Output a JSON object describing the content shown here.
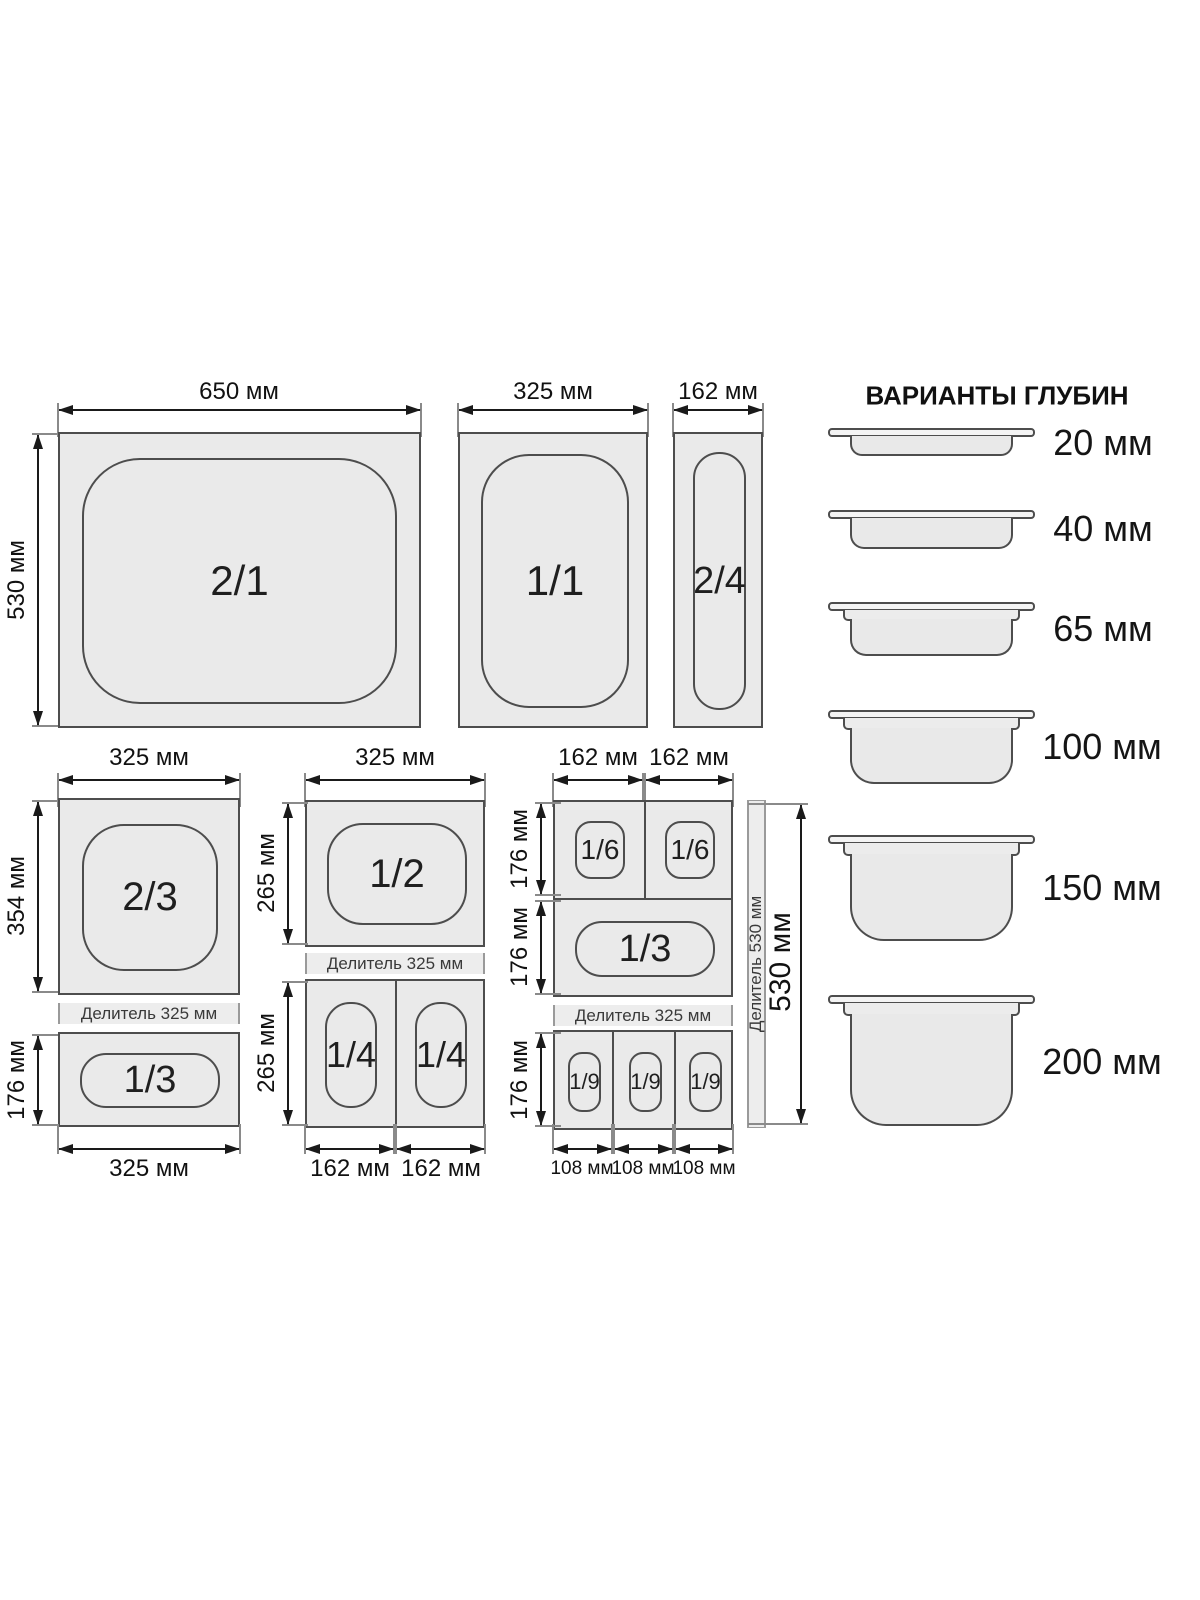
{
  "diagram": {
    "top_row": {
      "pan_2_1": {
        "label": "2/1",
        "width_dim": "650 мм",
        "height_dim": "530 мм"
      },
      "pan_1_1": {
        "label": "1/1",
        "width_dim": "325 мм"
      },
      "pan_2_4": {
        "label": "2/4",
        "width_dim": "162 мм"
      }
    },
    "left_column": {
      "top_dim": "325 мм",
      "pan_2_3": {
        "label": "2/3",
        "height_dim": "354 мм"
      },
      "divider_label": "Делитель 325 мм",
      "pan_1_3": {
        "label": "1/3",
        "height_dim": "176 мм"
      },
      "bottom_dim": "325 мм"
    },
    "middle_column": {
      "top_dim": "325 мм",
      "pan_1_2": {
        "label": "1/2",
        "height_dim": "265 мм"
      },
      "divider_label": "Делитель 325 мм",
      "pan_1_4_row": {
        "labels": [
          "1/4",
          "1/4"
        ],
        "height_dim": "265 мм",
        "bottom_dims": [
          "162 мм",
          "162 мм"
        ]
      }
    },
    "right_column": {
      "top_dims": [
        "162 мм",
        "162 мм"
      ],
      "pan_1_6_row": {
        "labels": [
          "1/6",
          "1/6"
        ],
        "height_dim": "176 мм"
      },
      "pan_1_3": {
        "label": "1/3",
        "height_dim": "176 мм"
      },
      "divider_label": "Делитель 325 мм",
      "pan_1_9_row": {
        "labels": [
          "1/9",
          "1/9",
          "1/9"
        ],
        "height_dim": "176 мм",
        "bottom_dims": [
          "108 мм",
          "108 мм",
          "108 мм"
        ]
      },
      "vertical_divider_label": "Делитель 530 мм",
      "side_dim": "530 мм"
    },
    "depths_panel": {
      "title": "ВАРИАНТЫ ГЛУБИН",
      "items": [
        {
          "label": "20 мм"
        },
        {
          "label": "40 мм"
        },
        {
          "label": "65 мм"
        },
        {
          "label": "100 мм"
        },
        {
          "label": "150 мм"
        },
        {
          "label": "200 мм"
        }
      ]
    },
    "colors": {
      "pan_fill": "#eaeaea",
      "outline": "#4d4d4d",
      "dim_line": "#1a1a1a"
    }
  }
}
